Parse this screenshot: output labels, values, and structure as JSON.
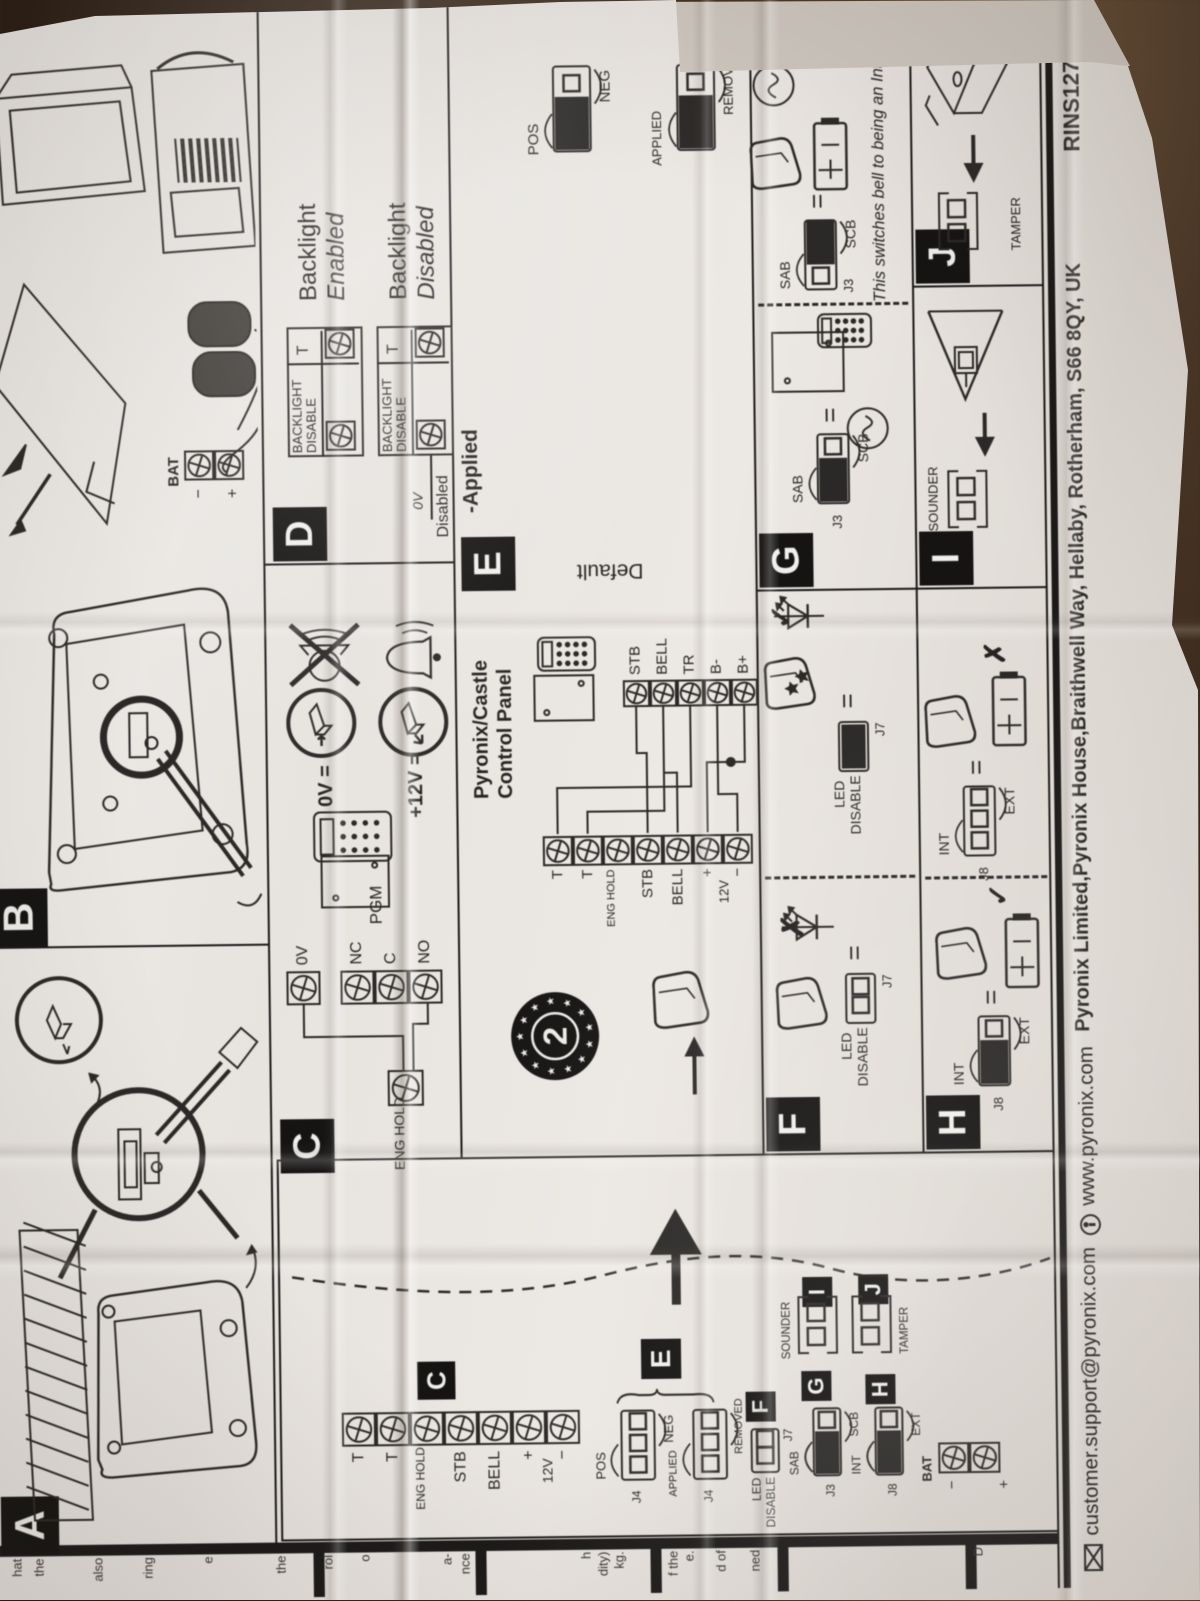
{
  "ref": "RINS1270-12",
  "footer": {
    "email": "customer.support@pyronix.com",
    "web": "www.pyronix.com",
    "address": "Pyronix Limited,Pyronix House,Braithwell Way, Hellaby, Rotherham, S66 8QY, UK"
  },
  "section_labels": {
    "a": "A",
    "b": "B",
    "c": "C",
    "d": "D",
    "e": "E",
    "f": "F",
    "g": "G",
    "h": "H",
    "i": "I",
    "j": "J"
  },
  "bell_terminals": [
    "T",
    "T",
    "ENG HOLD",
    "STB",
    "BELL",
    "+",
    "−"
  ],
  "bell_mid_label": "12V",
  "panel_terminals": [
    "STB",
    "BELL",
    "TR",
    "B-",
    "B+"
  ],
  "marks": {
    "check": "✓",
    "cross": "✗",
    "eq": "="
  },
  "c_sec": {
    "eng_hold": "ENG HOLD",
    "zero_v": "0V",
    "pgm": "PGM",
    "pgm_terms": [
      "NC",
      "C",
      "NO"
    ],
    "rule1": "0V =",
    "rule2": "+12V ="
  },
  "d_sec": {
    "backlight": "BACKLIGHT",
    "disable": "DISABLE",
    "t": "T",
    "enabled_1": "Backlight",
    "enabled_2": "Enabled",
    "disabled_1": "Backlight",
    "disabled_2": "Disabled",
    "wire_0v": "0V",
    "wire_disabled": "Disabled"
  },
  "e_sec": {
    "panel_1": "Pyronix/Castle",
    "panel_2": "Control Panel",
    "default": "Default",
    "pos": "POS",
    "neg": "NEG",
    "applied": "APPLIED",
    "removed": "REMOVED",
    "columns": [
      {
        "header": "-Applied",
        "pos_neg_black": "right",
        "app_rem_black": "left"
      },
      {
        "header": "-Removed",
        "pos_neg_black": "right",
        "app_rem_black": "right"
      },
      {
        "header": "+Removed",
        "pos_neg_black": "left",
        "app_rem_black": "right"
      },
      {
        "header": "+Applied",
        "pos_neg_black": "left",
        "app_rem_black": "left"
      }
    ]
  },
  "f_sec": {
    "led": "LED",
    "disable": "DISABLE",
    "j7": "J7"
  },
  "g_sec": {
    "j3": "J3",
    "sab": "SAB",
    "scb": "SCB",
    "note": "This switches bell to being an Internal Sounder"
  },
  "h_sec": {
    "j8": "J8",
    "int": "INT",
    "ext": "EXT"
  },
  "i_sec": {
    "sounder": "SOUNDER"
  },
  "j_sec": {
    "tamper": "TAMPER"
  },
  "legend": {
    "j4": "J4",
    "j7": "J7",
    "j3": "J3",
    "j8": "J8",
    "bat": "BAT",
    "neg": "−",
    "pos": "+",
    "pos_lbl": "POS",
    "neg_lbl": "NEG",
    "applied": "APPLIED",
    "removed": "REMOVED",
    "led": "LED",
    "disable": "DISABLE",
    "sab": "SAB",
    "scb": "SCB",
    "int": "INT",
    "ext": "EXT",
    "sounder": "SOUNDER",
    "tamper": "TAMPER"
  },
  "b_sec": {
    "bat": "BAT",
    "neg": "−",
    "pos": "+"
  },
  "emblem": {
    "number": "2"
  },
  "left_strip": {
    "fragments": [
      {
        "y": 14,
        "t": "hat"
      },
      {
        "y": 36,
        "t": "the"
      },
      {
        "y": 95,
        "t": "also"
      },
      {
        "y": 145,
        "t": "ring"
      },
      {
        "y": 205,
        "t": "e"
      },
      {
        "y": 278,
        "t": "the"
      },
      {
        "y": 325,
        "t": "rol"
      },
      {
        "y": 362,
        "t": "o"
      },
      {
        "y": 444,
        "t": "a-"
      },
      {
        "y": 462,
        "t": "nce"
      },
      {
        "y": 583,
        "t": "h"
      },
      {
        "y": 600,
        "t": "dity)"
      },
      {
        "y": 616,
        "t": "kg."
      },
      {
        "y": 670,
        "t": "f the"
      },
      {
        "y": 686,
        "t": "e."
      },
      {
        "y": 718,
        "t": "d of"
      },
      {
        "y": 752,
        "t": "ned"
      },
      {
        "y": 975,
        "t": "D"
      }
    ]
  }
}
